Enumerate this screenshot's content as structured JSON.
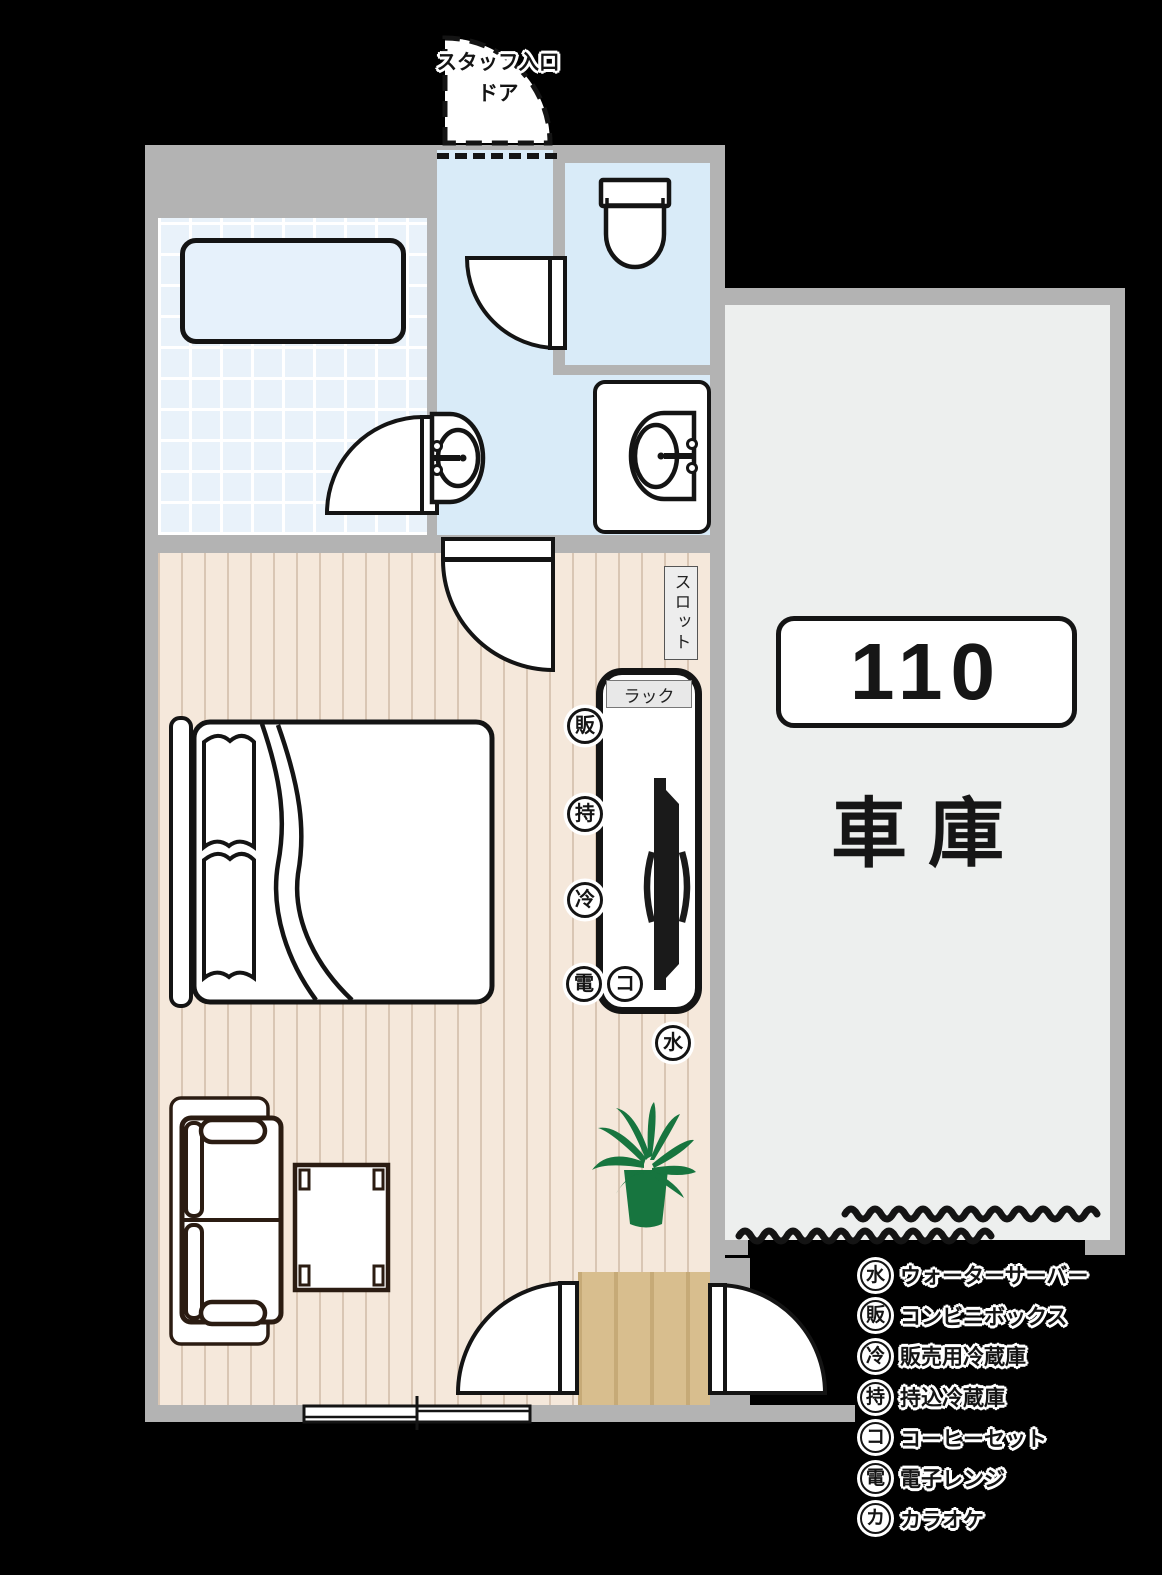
{
  "plan": {
    "staff_entrance_label_line1": "スタッフ入口",
    "staff_entrance_label_line2": "ドア",
    "slot_label": "スロット",
    "rack_label": "ラック",
    "room_number": "110",
    "garage_label": "車 庫",
    "amenity_markers": [
      {
        "id": "convenience-box",
        "char": "販"
      },
      {
        "id": "guest-fridge",
        "char": "持"
      },
      {
        "id": "sales-fridge",
        "char": "冷"
      },
      {
        "id": "microwave",
        "char": "電"
      },
      {
        "id": "coffee-set",
        "char": "コ"
      },
      {
        "id": "water-server",
        "char": "水"
      }
    ]
  },
  "legend": {
    "items": [
      {
        "symbol": "水",
        "label": "ウォーターサーバー"
      },
      {
        "symbol": "販",
        "label": "コンビニボックス"
      },
      {
        "symbol": "冷",
        "label": "販売用冷蔵庫"
      },
      {
        "symbol": "持",
        "label": "持込冷蔵庫"
      },
      {
        "symbol": "コ",
        "label": "コーヒーセット"
      },
      {
        "symbol": "電",
        "label": "電子レンジ"
      },
      {
        "symbol": "カ",
        "label": "カラオケ"
      }
    ]
  },
  "colors": {
    "wall": "#b3b3b3",
    "bedroom_floor": "#f5e8db",
    "wet_area_floor": "#d9ebf8",
    "bathroom_tile": "#e9f2fa",
    "garage_floor": "#edefee",
    "entry_wood": "#d8be8e",
    "plant_green": "#17753f",
    "line_black": "#141414"
  }
}
